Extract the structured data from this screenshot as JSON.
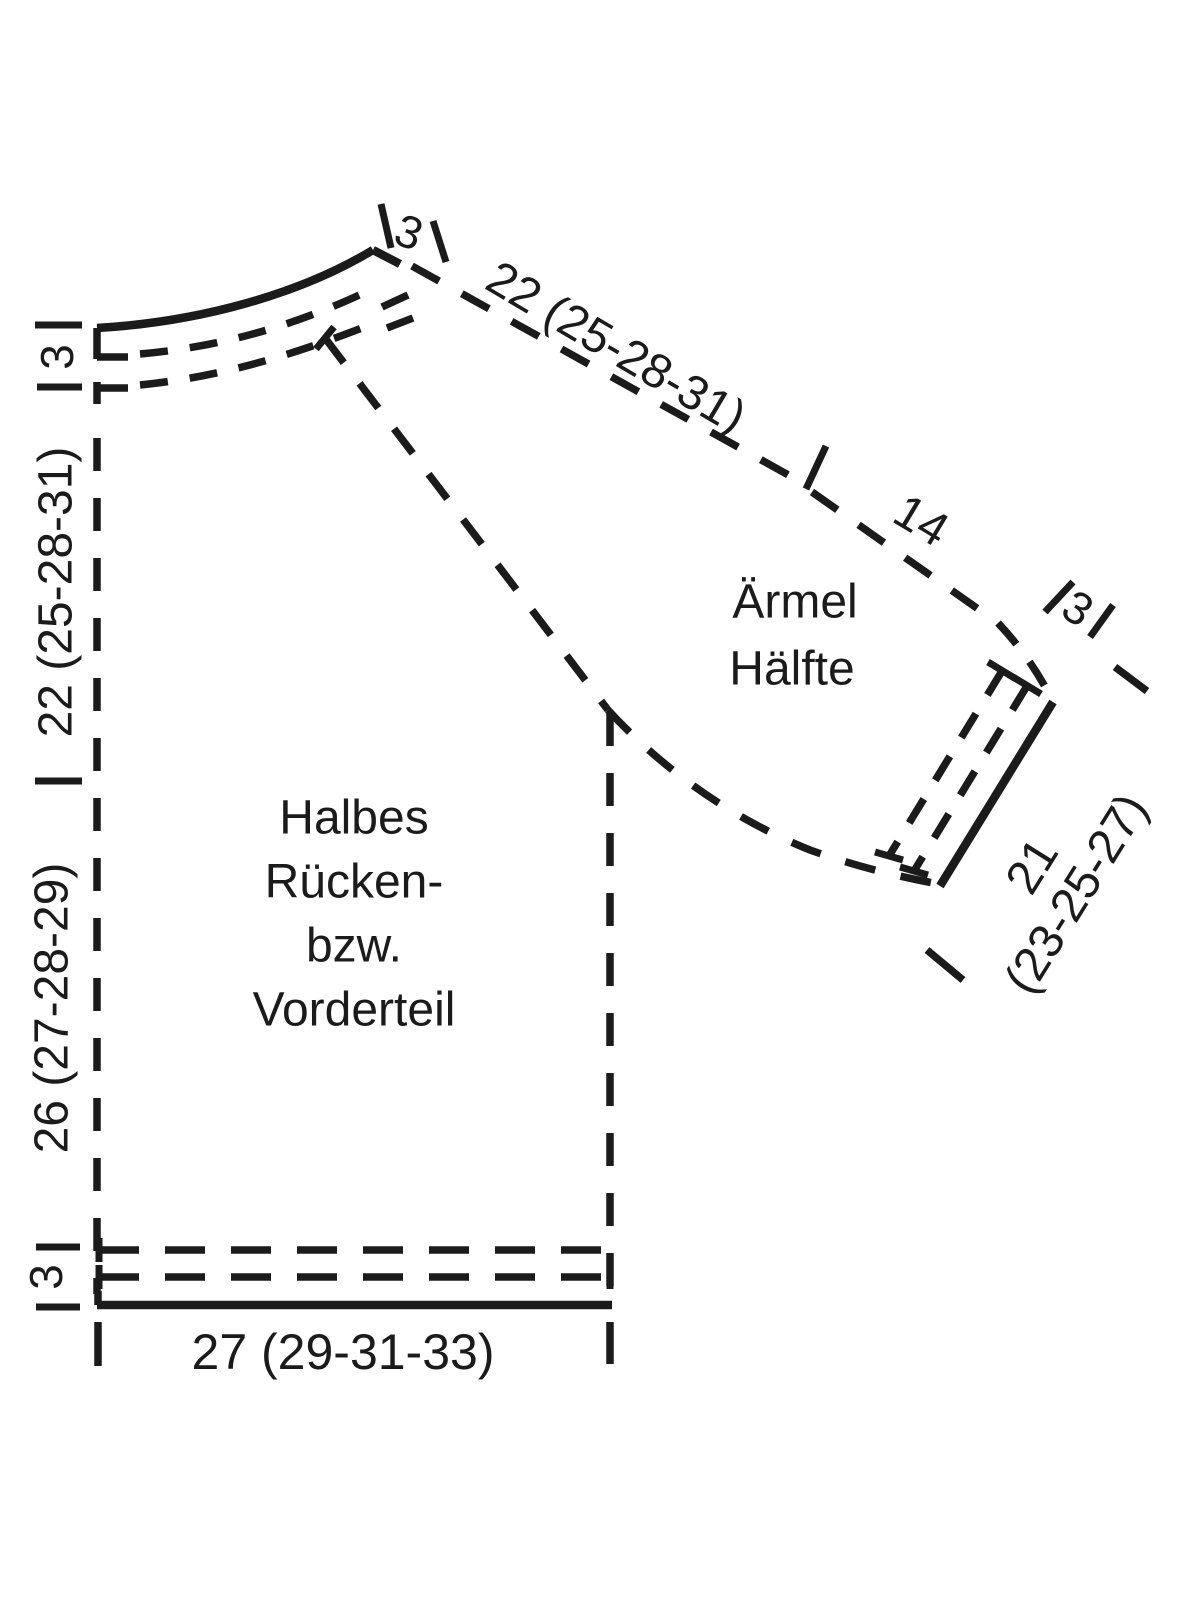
{
  "diagram": {
    "background": "#ffffff",
    "ink": "#1b1b1b",
    "body_piece": {
      "label_lines": [
        "Halbes",
        "Rücken-",
        "bzw.",
        "Vorderteil"
      ],
      "hem_width": "27 (29-31-33)",
      "hem_band_depth": "3",
      "side_height": "26 (27-28-29)",
      "raglan_height": "22 (25-28-31)",
      "neckband_depth": "3",
      "shoulder_band_width": "3"
    },
    "sleeve_piece": {
      "label_lines": [
        "Ärmel",
        "Hälfte"
      ],
      "raglan_length": "22 (25-28-31)",
      "lower_seam_length": "14",
      "cuff_band_depth": "3",
      "cuff_width_lines": [
        "21",
        "(23-25-27)"
      ]
    }
  }
}
